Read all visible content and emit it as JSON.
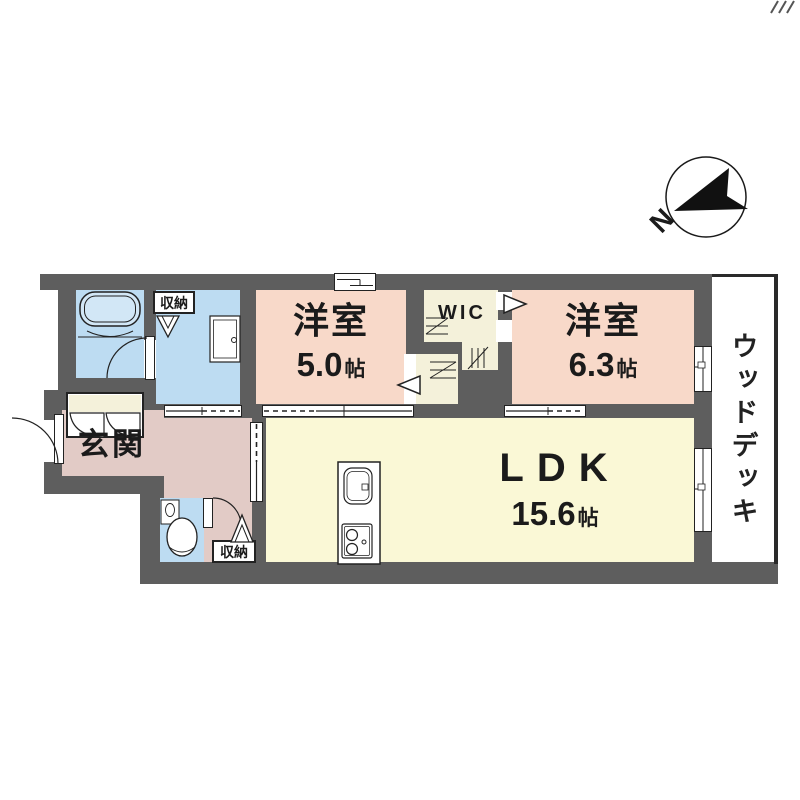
{
  "plan": {
    "compass": {
      "north_label": "N"
    },
    "rooms": {
      "bedroom_1": {
        "name": "洋室",
        "size_value": "5.0",
        "size_unit": "帖"
      },
      "bedroom_2": {
        "name": "洋室",
        "size_value": "6.3",
        "size_unit": "帖"
      },
      "ldk": {
        "name": "LDK",
        "size_value": "15.6",
        "size_unit": "帖"
      },
      "entrance": {
        "name": "玄関"
      },
      "wic": {
        "name": "WIC"
      },
      "wood_deck": {
        "name": "ウッドデッキ"
      },
      "storage_washroom": {
        "name": "収納"
      },
      "storage_hall": {
        "name": "収納"
      }
    },
    "colors": {
      "wall": "#5e5e5e",
      "bedroom_fill": "#f8d9c9",
      "ldk_fill": "#faf8d6",
      "entrance_hall_fill": "#e2cbc6",
      "wet_area_fill": "#bddcf2",
      "closet_fill": "#f4f1da",
      "deck_fill": "#ffffff",
      "line": "#222222"
    }
  }
}
